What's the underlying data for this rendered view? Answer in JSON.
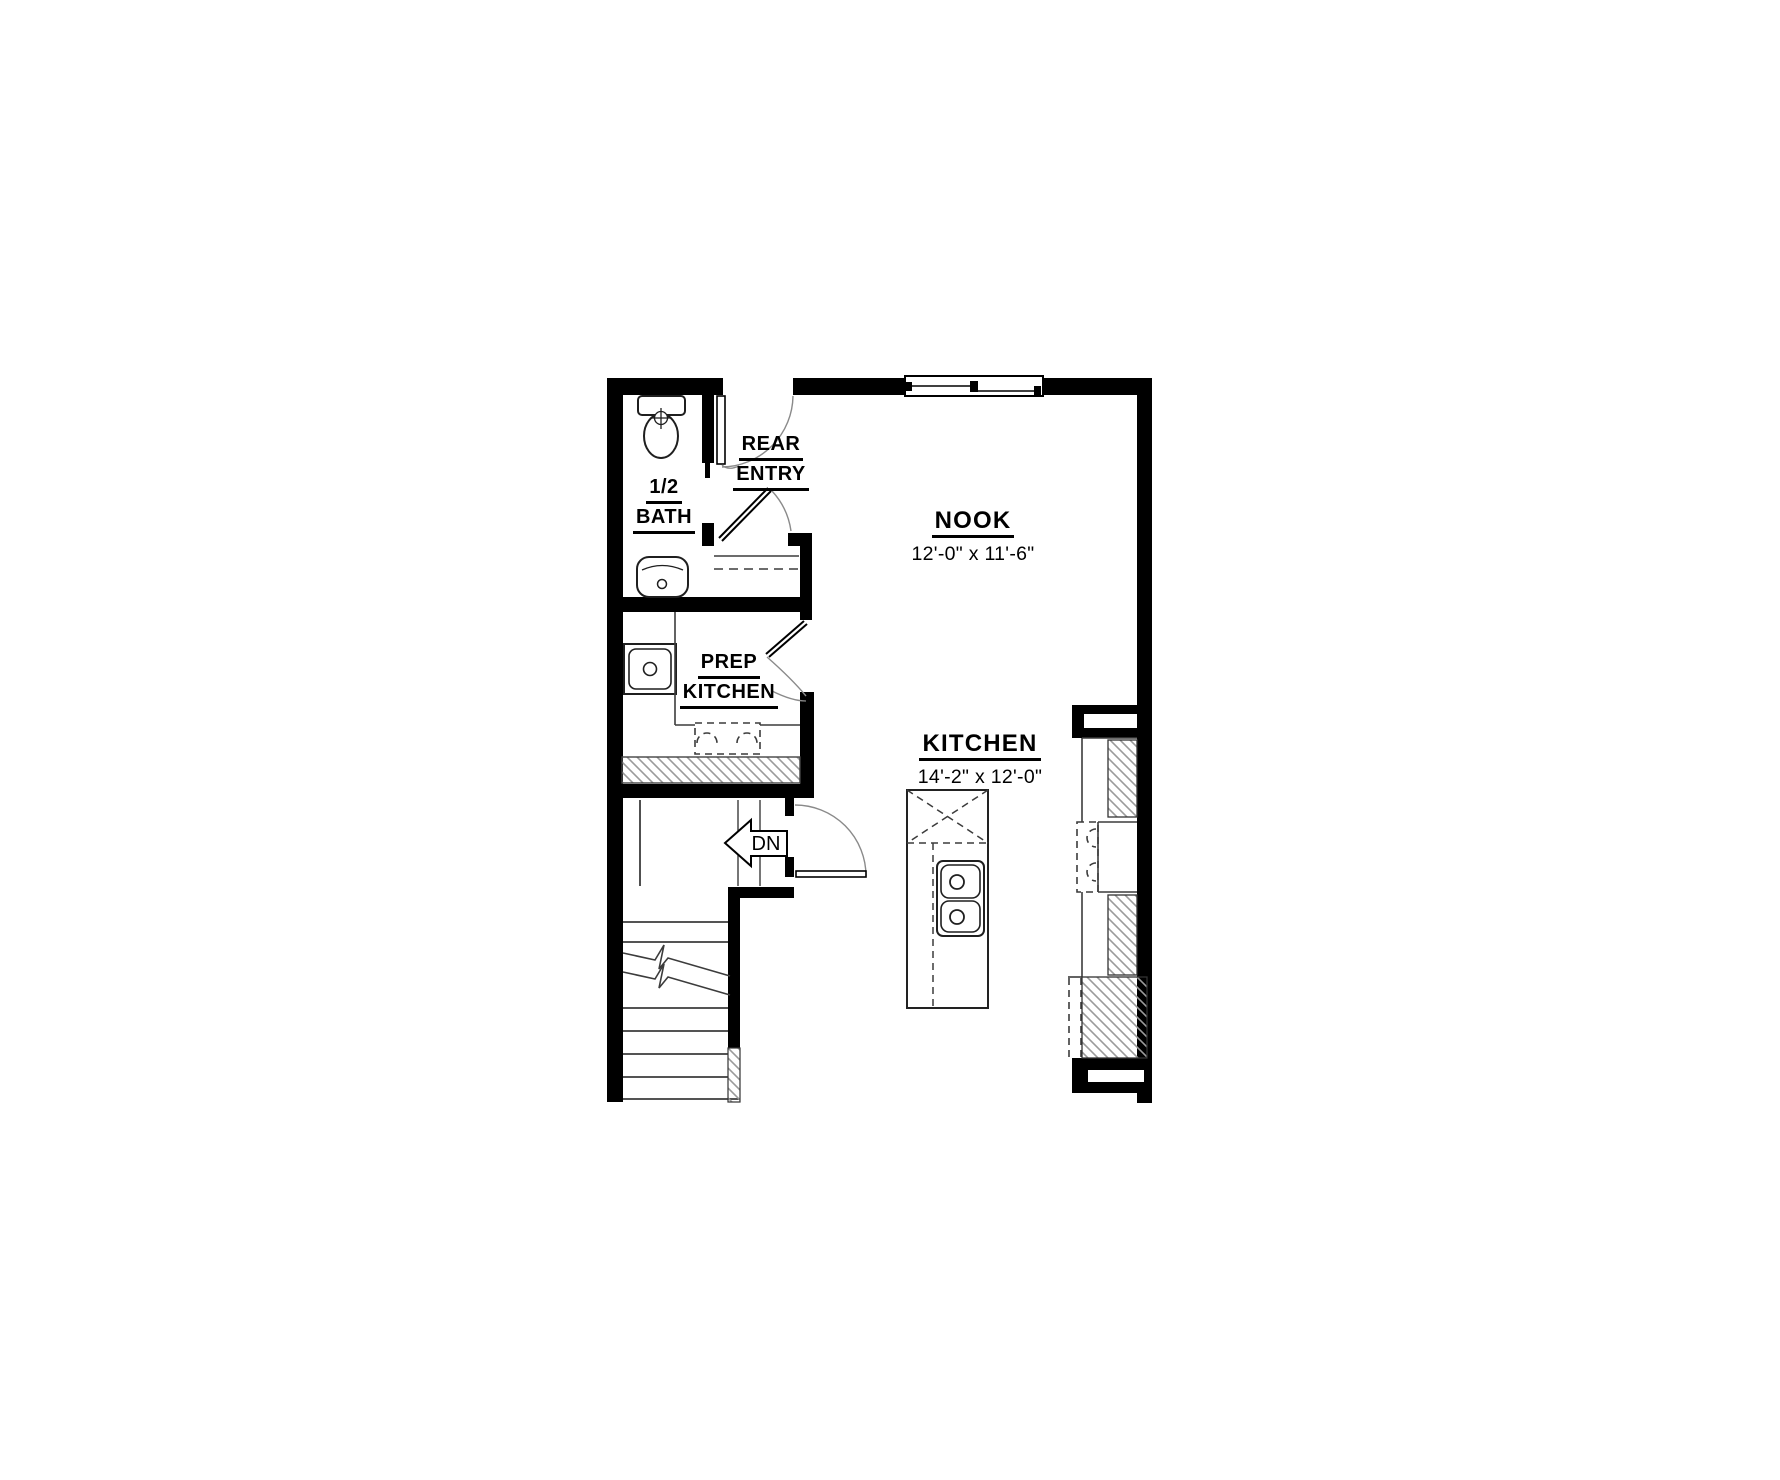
{
  "plan": {
    "labels": {
      "half_bath_line1": "1/2",
      "half_bath_line2": "BATH",
      "rear_entry_line1": "REAR",
      "rear_entry_line2": "ENTRY",
      "prep_kitchen_line1": "PREP",
      "prep_kitchen_line2": "KITCHEN",
      "nook_title": "NOOK",
      "nook_dims": "12'-0\" x 11'-6\"",
      "kitchen_title": "KITCHEN",
      "kitchen_dims": "14'-2\" x 12'-0\"",
      "stairs_down": "DN"
    },
    "colors": {
      "wall": "#000000",
      "fixture_line": "#1f1f1f",
      "thin_line": "#3c3c3c",
      "arc_line": "#8a8a8a",
      "hatch_line": "#9b9b9b",
      "background": "#ffffff"
    }
  }
}
